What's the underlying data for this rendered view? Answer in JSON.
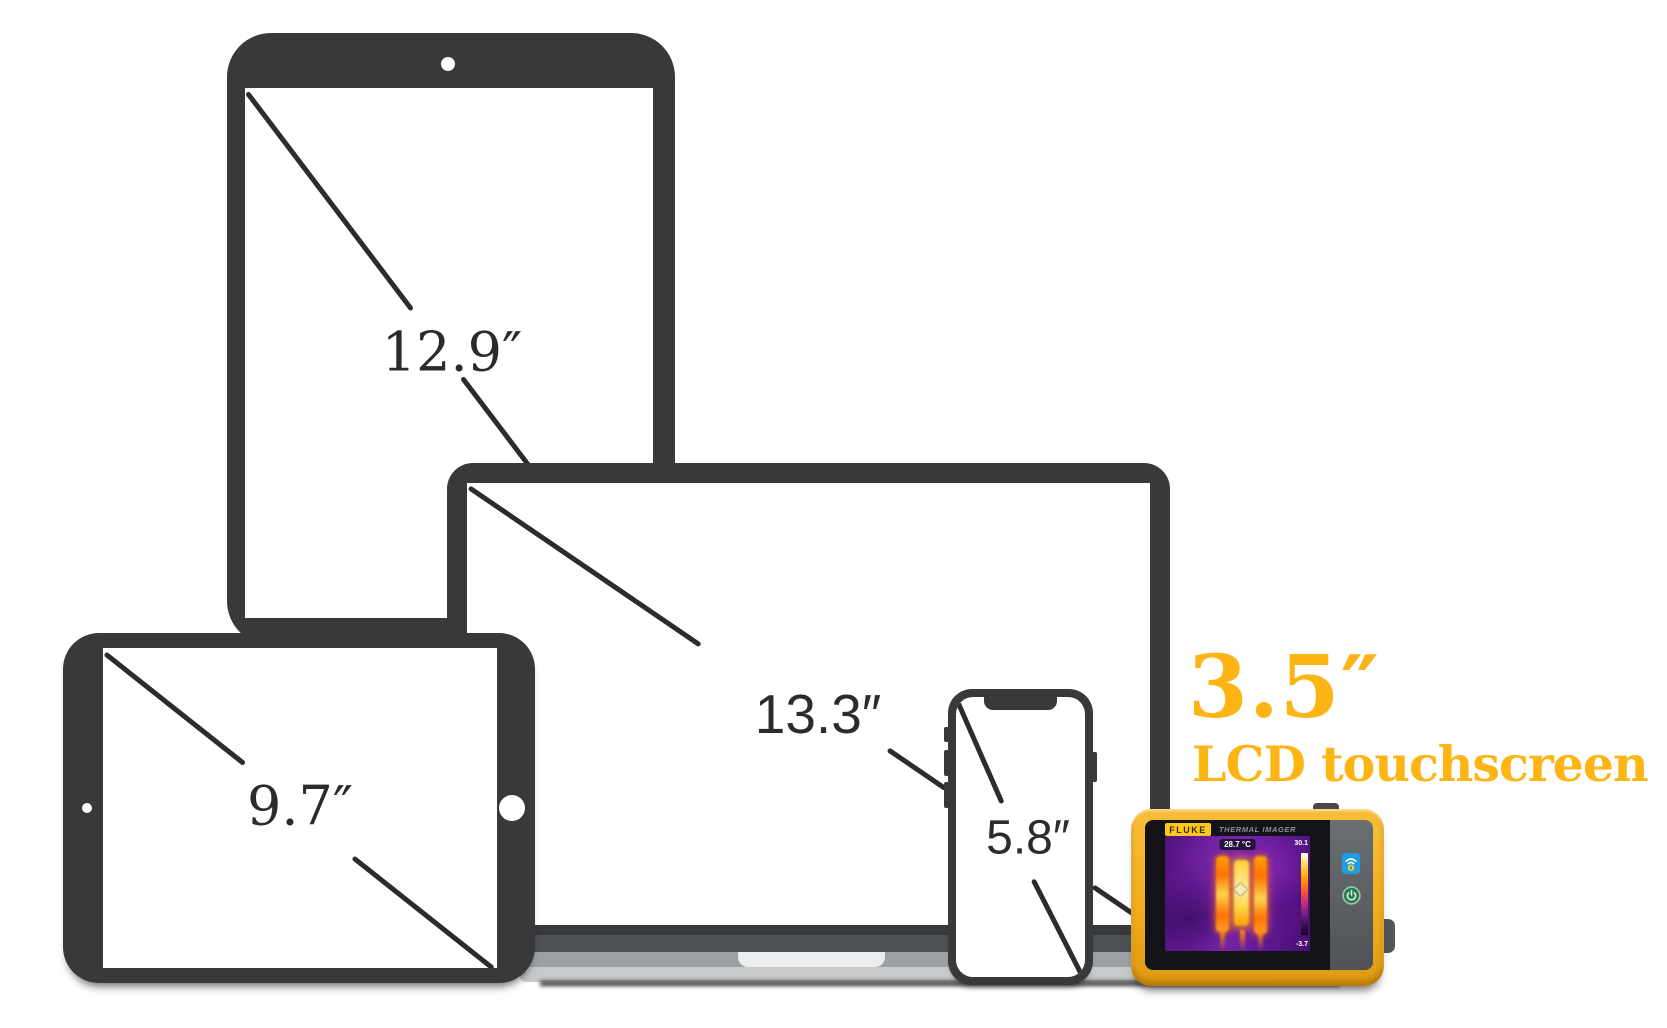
{
  "labels": {
    "tablet_large": "12.9″",
    "laptop": "13.3″",
    "tablet_small": "9.7″",
    "phone": "5.8″"
  },
  "headline": {
    "size": "3.5″",
    "subtitle": "LCD touchscreen",
    "color": "#FDB515"
  },
  "imager": {
    "brand": "FLUKE",
    "product_label": "THERMAL IMAGER",
    "body_color": "#F2AE1B",
    "display": {
      "spot_temp": "28.7 °C",
      "scale_max": "30.1",
      "scale_min": "-3.7",
      "palette_base_color": "#6B21A0"
    },
    "icons": [
      "fluke-connect-wifi-icon",
      "power-icon"
    ],
    "button_colors": {
      "fluke_connect": "#1F9DE4",
      "power": "#2C7C54"
    }
  }
}
